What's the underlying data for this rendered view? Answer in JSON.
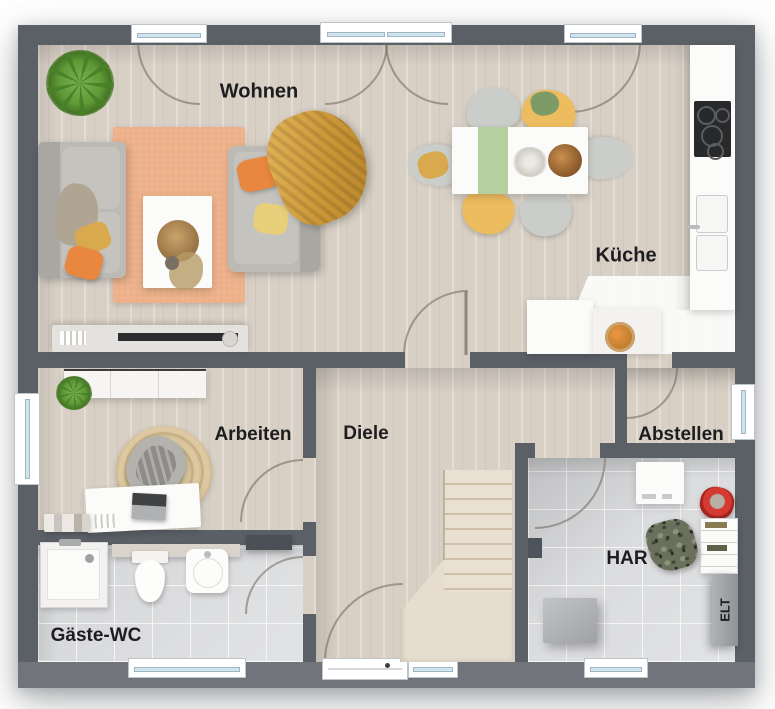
{
  "floorplan": {
    "rooms": {
      "wohnen": {
        "label": "Wohnen"
      },
      "kueche": {
        "label": "Küche"
      },
      "arbeiten": {
        "label": "Arbeiten"
      },
      "diele": {
        "label": "Diele"
      },
      "abstellen": {
        "label": "Abstellen"
      },
      "har": {
        "label": "HAR"
      },
      "gaeste_wc": {
        "label": "Gäste-WC"
      },
      "elt": {
        "label": "ELT"
      }
    },
    "colors": {
      "wall": "#5b6067",
      "wall_bottom": "#71757b",
      "floor_wood": "#d8d0c5",
      "floor_tile": "#e0e1e3",
      "rug_living": "#edb28b",
      "rug_office": "#d8c39c",
      "sofa_gray": "#bcbab5",
      "chair_yellow": "#edbc5e",
      "accent_orange": "#e8873d",
      "accent_mustard": "#d9a94e",
      "runner_green": "#b5cf9f",
      "bucket_red": "#d43a31",
      "plant_green": "#5f9a37",
      "counter_white": "#fbfbfa",
      "label_text": "#1d1d1f"
    }
  }
}
